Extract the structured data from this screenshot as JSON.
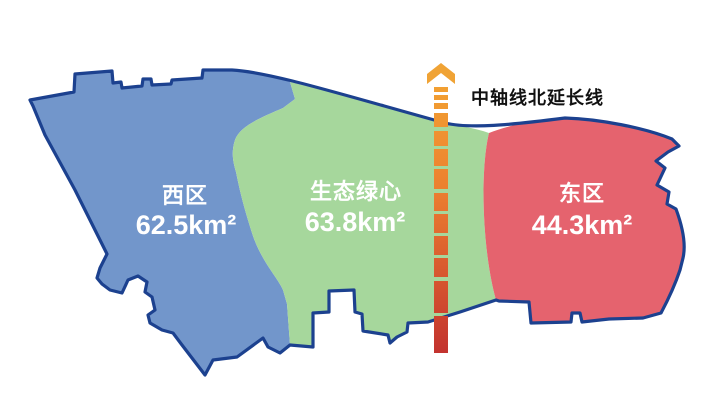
{
  "map": {
    "title_hint": "district-area-map",
    "regions": [
      {
        "id": "west",
        "name": "西区",
        "area": "62.5km²",
        "color": "#7296cb"
      },
      {
        "id": "green-heart",
        "name": "生态绿心",
        "area": "63.8km²",
        "color": "#a6d79c"
      },
      {
        "id": "east",
        "name": "东区",
        "area": "44.3km²",
        "color": "#e5636e"
      }
    ],
    "axis": {
      "label": "中轴线北延长线",
      "arrow_color": "#f0a335",
      "color_top": "#f2a032",
      "color_mid1": "#ec8030",
      "color_mid2": "#d95a2f",
      "color_bottom": "#c3332f"
    },
    "outline_color": "#1c418f",
    "region_text_color": "#ffffff",
    "axis_label_color": "#111111",
    "background_color": "#ffffff"
  }
}
